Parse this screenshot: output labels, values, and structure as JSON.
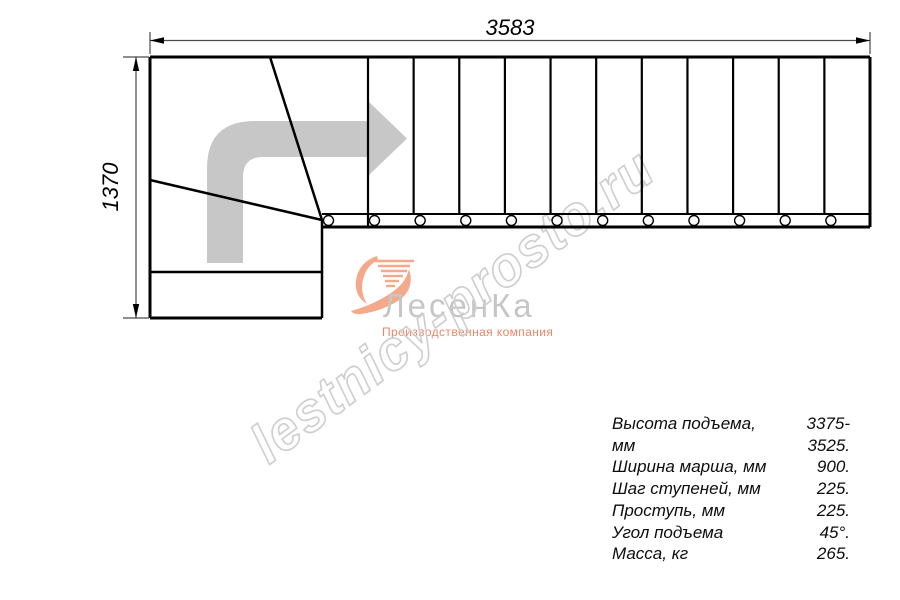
{
  "drawing": {
    "width_label": "3583",
    "depth_label": "1370",
    "line_color": "#000000",
    "dim_color": "#4a4a4a",
    "arrow_color": "#c7c7c7",
    "steps_count": 12
  },
  "watermark": {
    "text": "lestnicy-prosto.ru",
    "color": "#cfcfcf"
  },
  "logo": {
    "name": "ЛесенКа",
    "tagline": "Производственная компания",
    "name_color": "#c6c6c6",
    "accent_color": "#ee8666",
    "swoosh_color": "#f4a98b"
  },
  "specs": {
    "rows": [
      {
        "label": "Высота подъема, мм",
        "value": "3375-3525."
      },
      {
        "label": "Ширина марша, мм",
        "value": "900."
      },
      {
        "label": "Шаг ступеней, мм",
        "value": "225."
      },
      {
        "label": "Проступь, мм",
        "value": "225."
      },
      {
        "label": "Угол подъема",
        "value": "45°."
      },
      {
        "label": "Масса, кг",
        "value": "265."
      }
    ]
  }
}
